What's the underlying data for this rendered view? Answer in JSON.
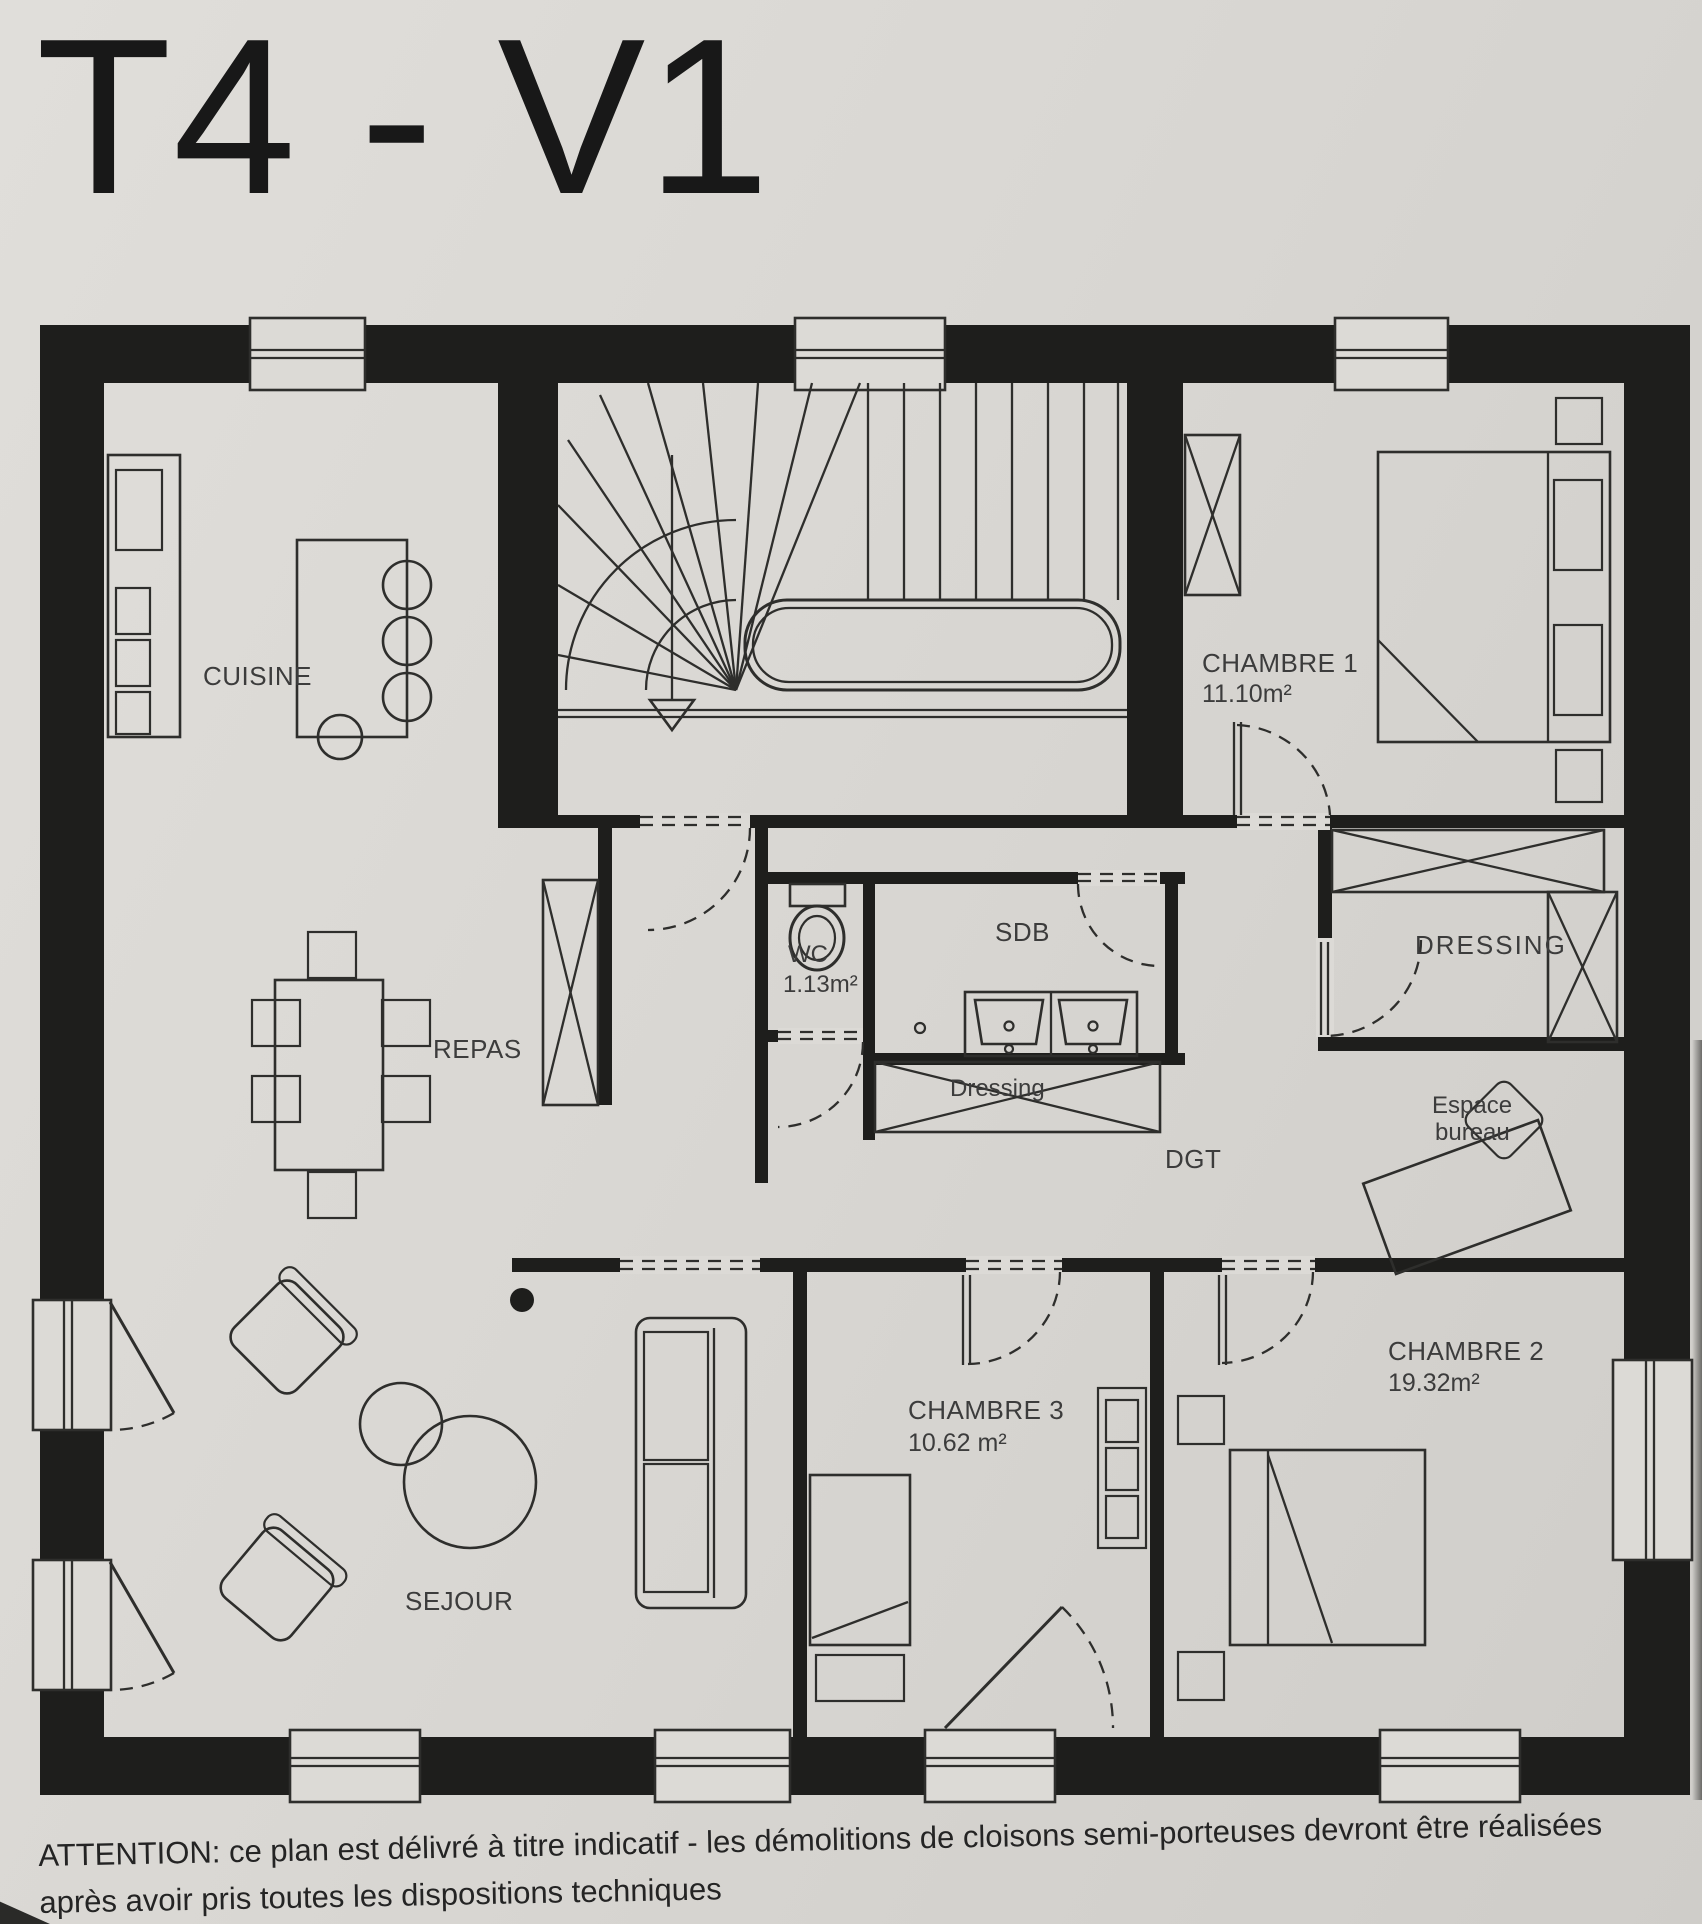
{
  "colors": {
    "paper": "#d9d7d3",
    "paper2": "#dcdad6",
    "ink": "#1e1e1c",
    "line": "#2e2e2c",
    "label": "#3c3c3c",
    "caption": "#242424",
    "title": "#181818"
  },
  "title": "T4 - V1",
  "plan": {
    "rooms": {
      "cuisine": {
        "label": "CUISINE"
      },
      "repas": {
        "label": "REPAS"
      },
      "sejour": {
        "label": "SEJOUR"
      },
      "wc": {
        "label": "WC",
        "area": "1.13m²"
      },
      "sdb": {
        "label": "SDB"
      },
      "dressing_closet": {
        "label": "Dressing"
      },
      "dgt": {
        "label": "DGT"
      },
      "chambre1": {
        "label": "CHAMBRE 1",
        "area": "11.10m²"
      },
      "dressing_room": {
        "label": "DRESSING"
      },
      "espace_bureau": {
        "label_line1": "Espace",
        "label_line2": "bureau"
      },
      "chambre2": {
        "label": "CHAMBRE 2",
        "area": "19.32m²"
      },
      "chambre3": {
        "label": "CHAMBRE 3",
        "area": "10.62 m²"
      }
    }
  },
  "caption": {
    "line1": "ATTENTION: ce plan est délivré à titre indicatif  - les démolitions de cloisons semi-porteuses devront être réalisées",
    "line2": "après avoir pris toutes les dispositions techniques"
  }
}
